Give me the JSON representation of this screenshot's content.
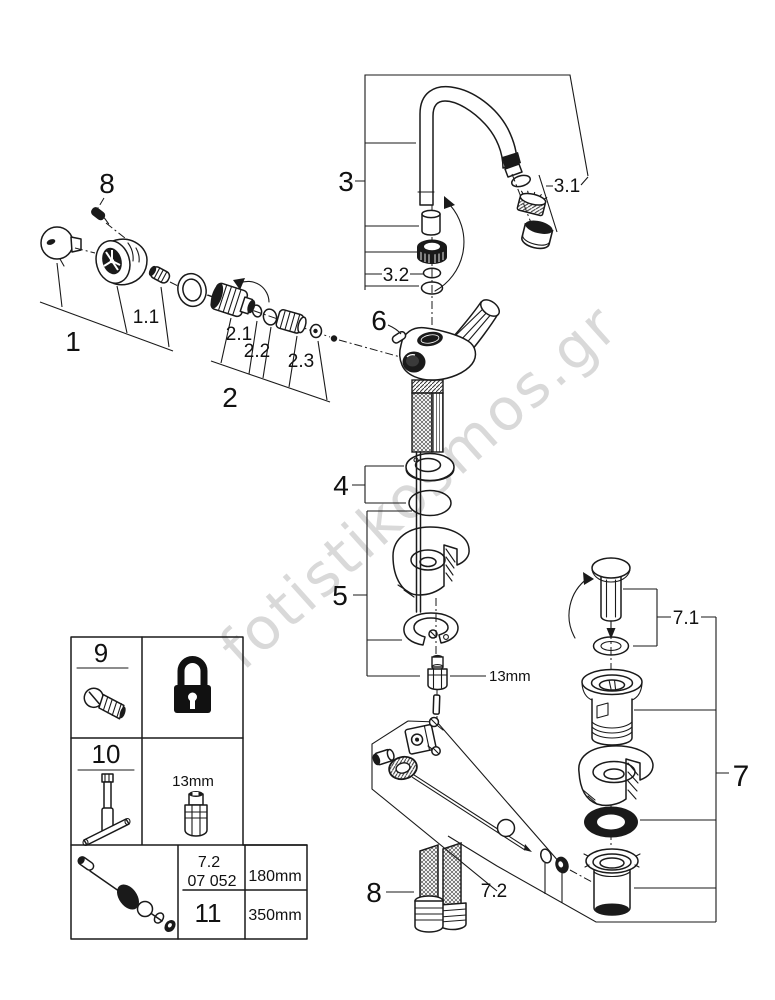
{
  "diagram": {
    "watermark": "fotistikosmos.gr",
    "callouts": {
      "top_screw": "8",
      "handle": "1",
      "handle_screw": "1.1",
      "cartridge": "2",
      "cartridge_washer": "2.1",
      "cartridge_oring": "2.2",
      "cartridge_bushing": "2.3",
      "spout": "3",
      "aerator": "3.1",
      "spout_orings": "3.2",
      "escutcheon": "4",
      "fixing_set": "5",
      "body": "6",
      "waste_set": "7",
      "plug": "7.1",
      "popup_rod": "7.2",
      "hoses": "8",
      "nut_size": "13mm"
    },
    "legend": {
      "screw_item": "9",
      "wrench_item": "10",
      "socket_size": "13mm",
      "rod_ref": "7.2",
      "rod_code": "07 052",
      "rod_item": "11",
      "rod_length_short": "180mm",
      "rod_length_long": "350mm"
    },
    "icons": [
      "padlock-icon",
      "screw-icon",
      "socket-wrench-icon",
      "socket-13mm-icon",
      "popup-rod-icon"
    ],
    "colors": {
      "line": "#1a1a1a",
      "watermark": "#d9d9d9",
      "background": "#ffffff"
    }
  }
}
